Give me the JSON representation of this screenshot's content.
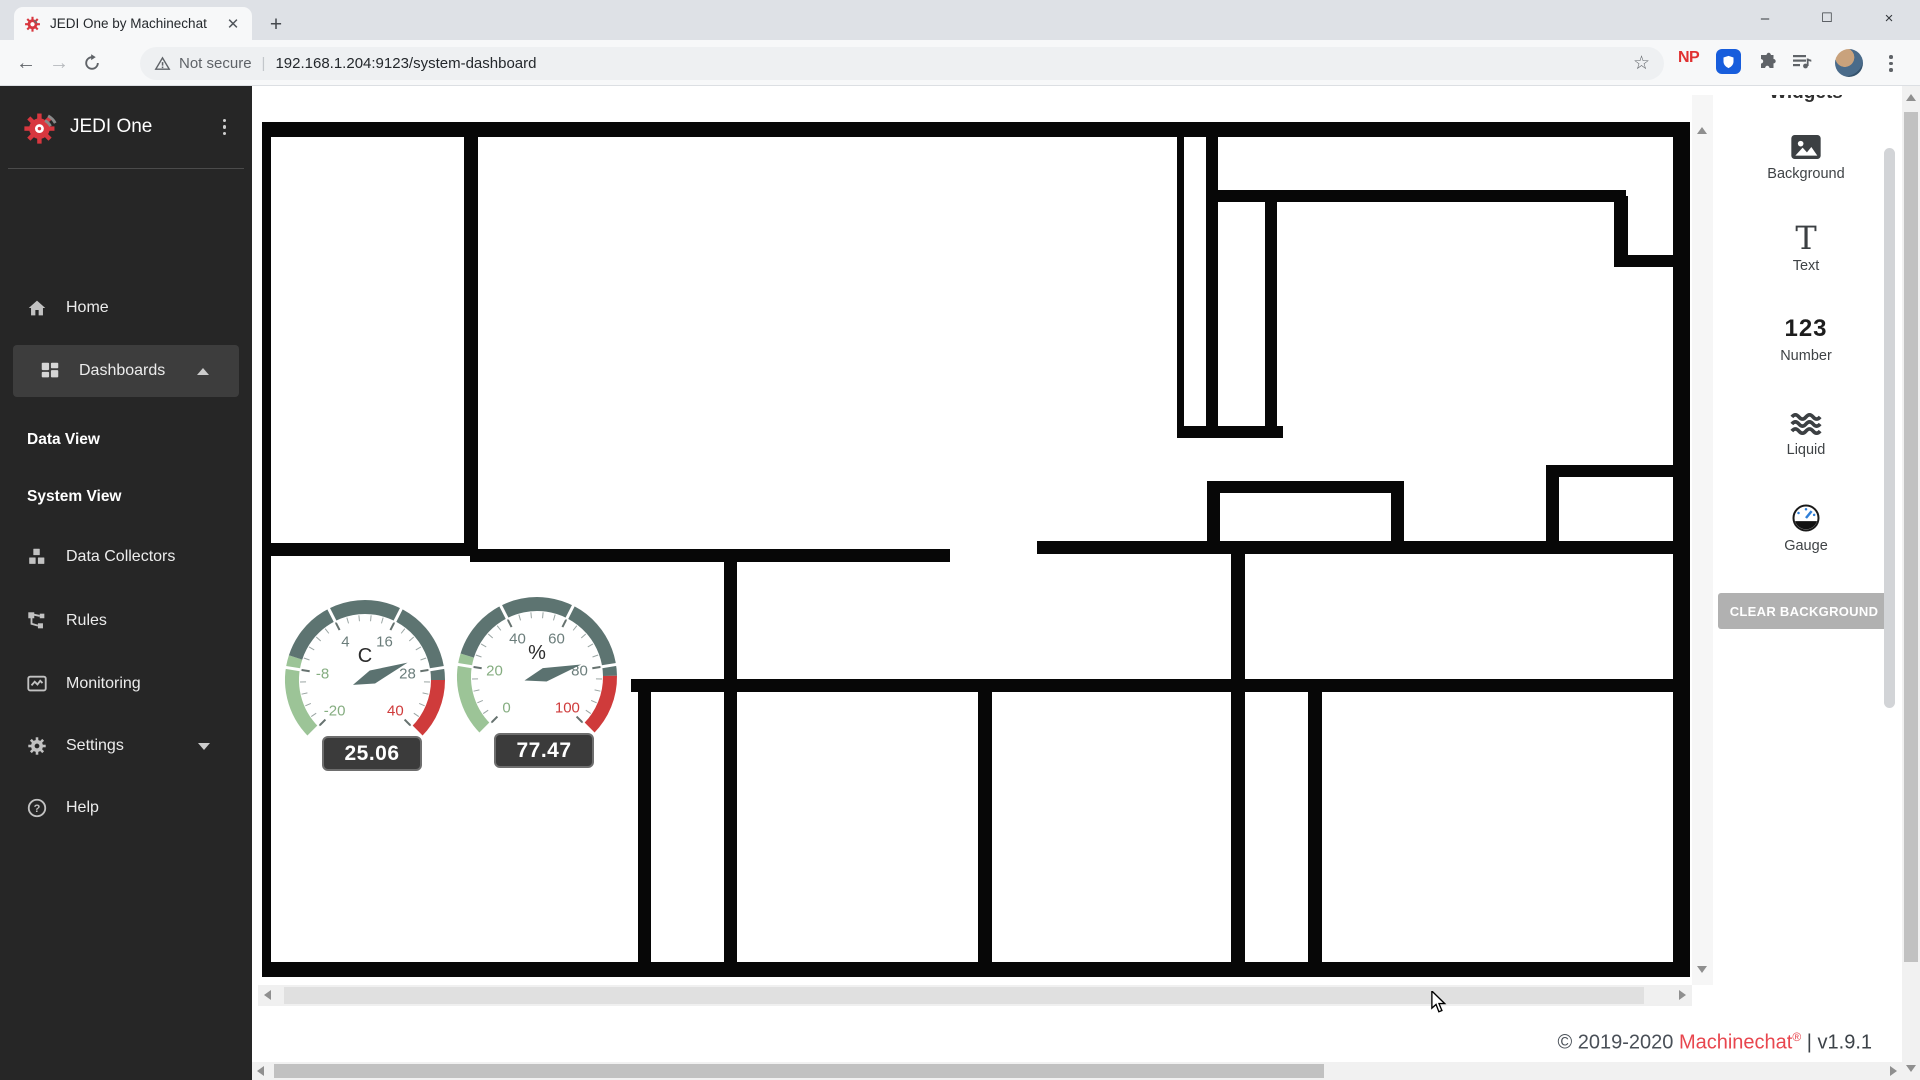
{
  "browser": {
    "tab_title": "JEDI One by Machinechat",
    "new_tab_button": "+",
    "window_controls": {
      "minimize": "–",
      "maximize": "❐",
      "close": "×"
    },
    "security_label": "Not secure",
    "url": "192.168.1.204:9123/system-dashboard",
    "np_badge": "NP",
    "star_icon": "☆",
    "back_arrow": "←",
    "forward_arrow": "→"
  },
  "sidebar": {
    "app_name": "JEDI One",
    "items": [
      {
        "label": "Home",
        "icon": "home-icon"
      },
      {
        "label": "Dashboards",
        "icon": "dashboard-grid-icon",
        "active": true,
        "expanded": true
      },
      {
        "label": "Data View",
        "type": "subitem"
      },
      {
        "label": "System View",
        "type": "subitem"
      },
      {
        "label": "Data Collectors",
        "icon": "cubes-icon"
      },
      {
        "label": "Rules",
        "icon": "rules-flow-icon"
      },
      {
        "label": "Monitoring",
        "icon": "monitoring-icon"
      },
      {
        "label": "Settings",
        "icon": "gear-icon",
        "expandable": true
      },
      {
        "label": "Help",
        "icon": "help-icon"
      }
    ]
  },
  "widgets_panel": {
    "title": "Widgets",
    "items": [
      {
        "label": "Background",
        "icon": "image-icon"
      },
      {
        "label": "Text",
        "icon": "text-icon",
        "glyph": "T"
      },
      {
        "label": "Number",
        "icon": "number-icon",
        "glyph": "123"
      },
      {
        "label": "Liquid",
        "icon": "waves-icon"
      },
      {
        "label": "Gauge",
        "icon": "gauge-icon"
      }
    ],
    "clear_button": "CLEAR BACKGROUND"
  },
  "footer": {
    "copyright": "© 2019-2020 ",
    "brand": "Machinechat",
    "reg": "®",
    "version": " | v1.9.1"
  },
  "colors": {
    "accent_red": "#d8373f",
    "sidebar_bg": "#262626",
    "active_item_bg": "#3d3d3d",
    "gauge_green": "#9cc497",
    "gauge_slate": "#5d7471",
    "gauge_red": "#cf3b3b"
  },
  "chart_data": [
    {
      "type": "gauge",
      "name": "temperature-gauge",
      "unit": "C",
      "value": 25.06,
      "value_label": "25.06",
      "min": -20,
      "max": 40,
      "major_ticks": [
        -20,
        -8,
        4,
        16,
        28,
        40
      ],
      "tick_label_colors": [
        "green",
        "green",
        "gray",
        "gray",
        "gray",
        "red"
      ],
      "zones": [
        {
          "from": -20,
          "to": -6,
          "color": "#9cc497"
        },
        {
          "from": -6,
          "to": 30,
          "color": "#5d7471"
        },
        {
          "from": 30,
          "to": 40,
          "color": "#cf3b3b"
        }
      ],
      "needle_color": "#5b7270",
      "sweep_degrees": 270
    },
    {
      "type": "gauge",
      "name": "humidity-gauge",
      "unit": "%",
      "value": 77.47,
      "value_label": "77.47",
      "min": 0,
      "max": 100,
      "major_ticks": [
        0,
        20,
        40,
        60,
        80,
        100
      ],
      "tick_label_colors": [
        "green",
        "green",
        "gray",
        "gray",
        "gray",
        "red"
      ],
      "zones": [
        {
          "from": 0,
          "to": 23,
          "color": "#9cc497"
        },
        {
          "from": 23,
          "to": 83,
          "color": "#5d7471"
        },
        {
          "from": 83,
          "to": 100,
          "color": "#cf3b3b"
        }
      ],
      "needle_color": "#5b7270",
      "sweep_degrees": 270
    }
  ]
}
